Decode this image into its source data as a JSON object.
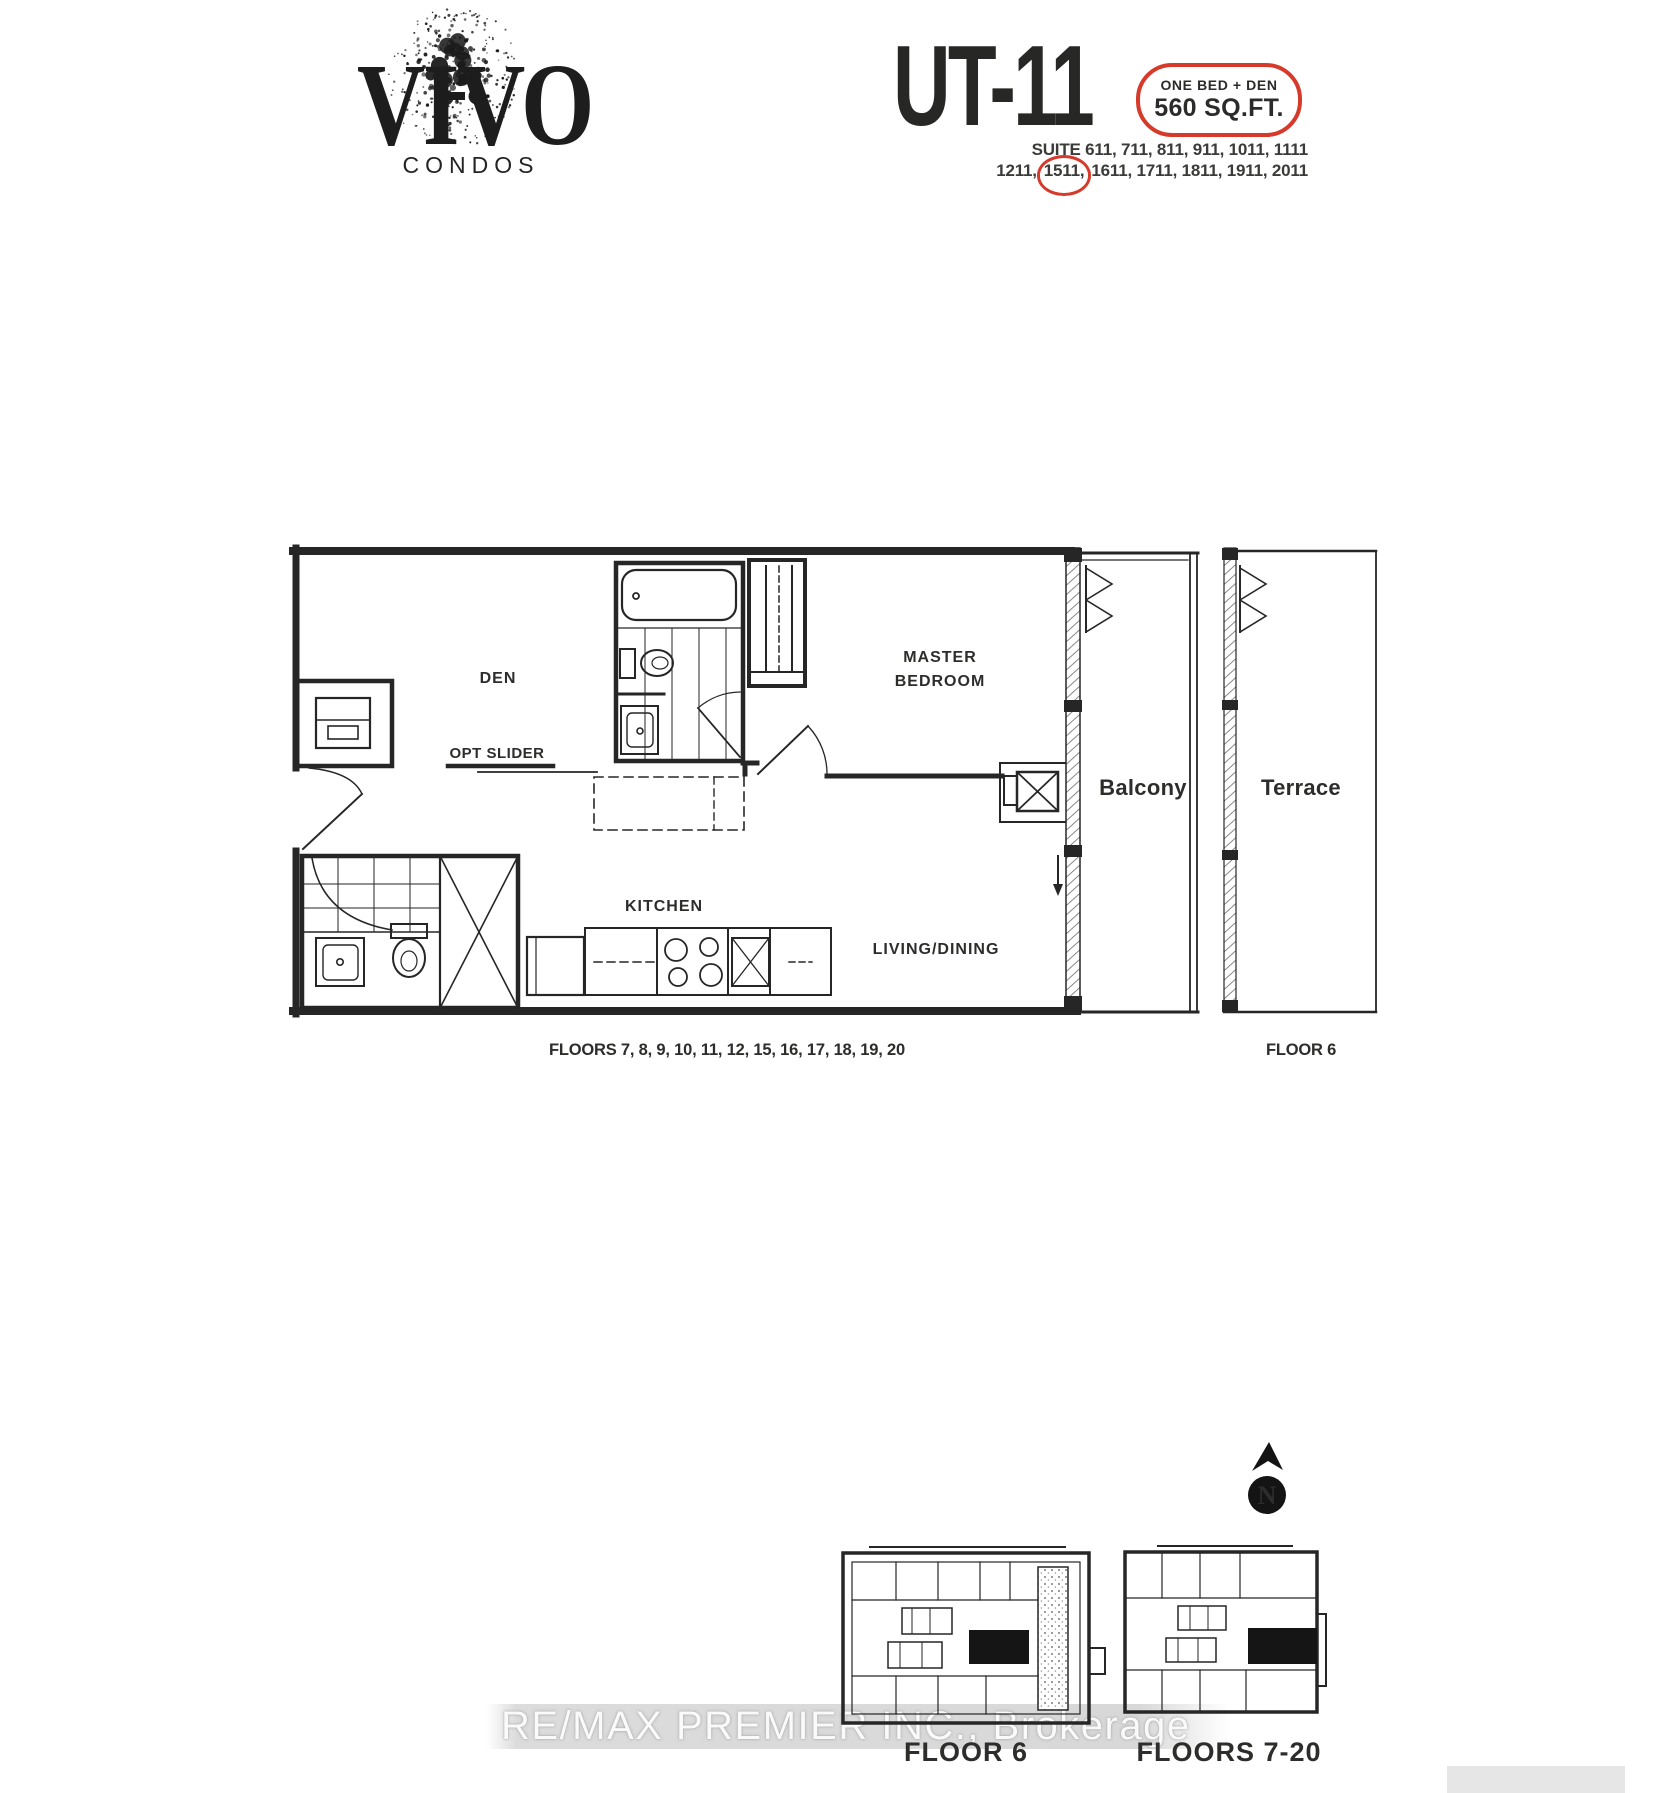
{
  "brand": {
    "name": "VIVO",
    "sub": "CONDOS"
  },
  "header": {
    "unit_code": "UT-11",
    "badge": {
      "line1": "ONE BED + DEN",
      "line2": "560 SQ.FT."
    },
    "suites_line1": "SUITE 611, 711, 811, 911, 1011, 1111",
    "suites_line2": {
      "pre": "1211,",
      "circled": "1511,",
      "post": "1611, 1711, 1811, 1911, 2011"
    }
  },
  "plan": {
    "labels": {
      "den": "DEN",
      "opt_slider": "OPT SLIDER",
      "master_line1": "MASTER",
      "master_line2": "BEDROOM",
      "kitchen": "KITCHEN",
      "living_dining": "LIVING/DINING",
      "balcony": "Balcony",
      "terrace": "Terrace",
      "floors_note": "FLOORS 7, 8, 9, 10, 11, 12, 15, 16, 17, 18, 19, 20",
      "floor6_note": "FLOOR 6"
    }
  },
  "keyplans": {
    "floor6": "FLOOR 6",
    "floors720": "FLOORS 7-20",
    "north": "N"
  },
  "watermark": "RE/MAX PREMIER INC., Brokerage",
  "colors": {
    "accent_red": "#d63a2a",
    "ink": "#262626",
    "highlight_unit": "#151515",
    "watermark_band": "#c6c6c6"
  }
}
